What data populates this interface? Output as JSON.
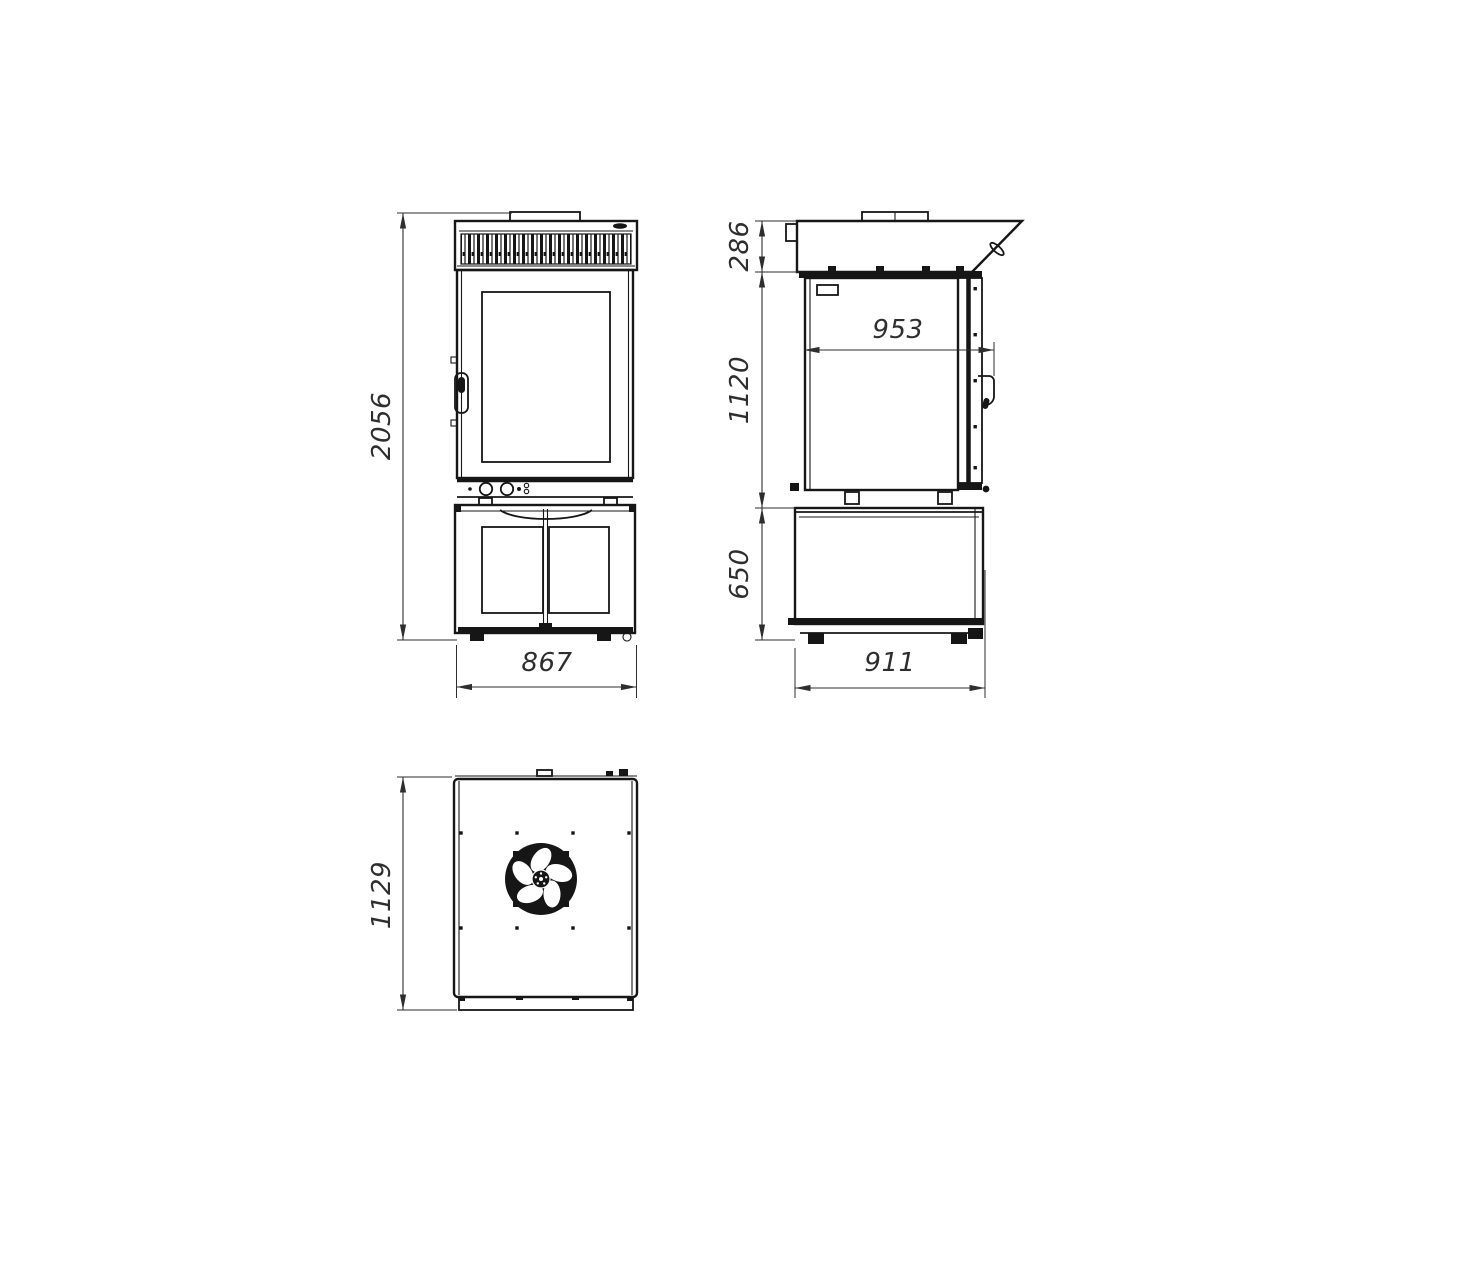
{
  "style": {
    "background": "#ffffff",
    "line_color": "#161616",
    "dim_text_color": "#2e2e2e"
  },
  "views": {
    "front": {
      "label": "front-view",
      "dims": {
        "total_height": "2056",
        "base_width": "867"
      }
    },
    "side": {
      "label": "side-view",
      "dims": {
        "hood_height": "286",
        "oven_height": "1120",
        "oven_depth": "953",
        "stand_height": "650",
        "stand_depth": "911"
      }
    },
    "top": {
      "label": "top-view",
      "dims": {
        "overall_depth": "1129"
      }
    }
  }
}
